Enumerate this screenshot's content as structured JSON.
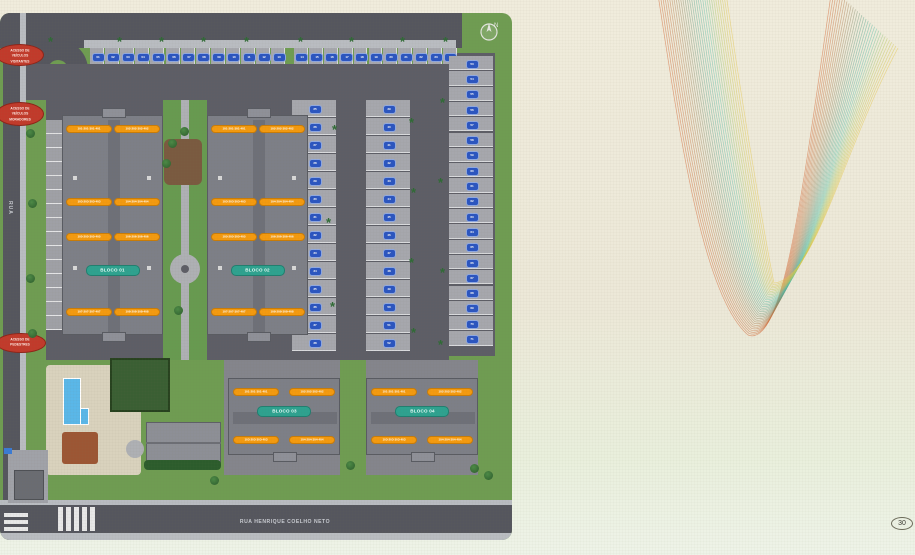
{
  "page": {
    "badge": "30"
  },
  "plan": {
    "streets": {
      "bottom": "RUA HENRIQUE COELHO NETO",
      "left": "RUA"
    },
    "compass": {
      "label": "N"
    },
    "access_labels": [
      {
        "x": -4,
        "y": 31,
        "w": 48,
        "h": 22,
        "lines": [
          "ACESSO DE",
          "VEÍCULOS",
          "VISITANTES"
        ]
      },
      {
        "x": -4,
        "y": 89,
        "w": 48,
        "h": 24,
        "lines": [
          "ACESSO DE",
          "VEÍCULOS",
          "MORADORES"
        ]
      },
      {
        "x": -4,
        "y": 320,
        "w": 50,
        "h": 20,
        "lines": [
          "ACESSO DE",
          "PEDESTRES"
        ]
      }
    ],
    "blocks": [
      {
        "name": "BLOCO 01",
        "orient": "v",
        "x": 62,
        "y": 102,
        "w": 101,
        "h": 220,
        "pill_y": 150,
        "units": [
          {
            "x": 4,
            "y": 10,
            "t": "101·201·301·401"
          },
          {
            "x": 52,
            "y": 10,
            "t": "102·202·302·402"
          },
          {
            "x": 4,
            "y": 83,
            "t": "103·203·303·403"
          },
          {
            "x": 52,
            "y": 83,
            "t": "104·204·304·404"
          },
          {
            "x": 4,
            "y": 118,
            "t": "105·205·305·405"
          },
          {
            "x": 52,
            "y": 118,
            "t": "106·206·306·406"
          },
          {
            "x": 4,
            "y": 193,
            "t": "107·207·307·407"
          },
          {
            "x": 52,
            "y": 193,
            "t": "108·208·308·408"
          }
        ]
      },
      {
        "name": "BLOCO 02",
        "orient": "v",
        "x": 207,
        "y": 102,
        "w": 101,
        "h": 220,
        "pill_y": 150,
        "units": [
          {
            "x": 4,
            "y": 10,
            "t": "101·201·301·401"
          },
          {
            "x": 52,
            "y": 10,
            "t": "102·202·302·402"
          },
          {
            "x": 4,
            "y": 83,
            "t": "103·203·303·403"
          },
          {
            "x": 52,
            "y": 83,
            "t": "104·204·304·404"
          },
          {
            "x": 4,
            "y": 118,
            "t": "105·205·305·405"
          },
          {
            "x": 52,
            "y": 118,
            "t": "106·206·306·406"
          },
          {
            "x": 4,
            "y": 193,
            "t": "107·207·307·407"
          },
          {
            "x": 52,
            "y": 193,
            "t": "108·208·308·408"
          }
        ]
      },
      {
        "name": "BLOCO 03",
        "orient": "h",
        "x": 228,
        "y": 365,
        "w": 112,
        "h": 77,
        "pill_y": 28,
        "units": [
          {
            "x": 5,
            "y": 10,
            "t": "101·201·301·401"
          },
          {
            "x": 61,
            "y": 10,
            "t": "102·202·302·402"
          },
          {
            "x": 5,
            "y": 58,
            "t": "103·203·303·403"
          },
          {
            "x": 61,
            "y": 58,
            "t": "104·204·304·404"
          }
        ]
      },
      {
        "name": "BLOCO 04",
        "orient": "h",
        "x": 366,
        "y": 365,
        "w": 112,
        "h": 77,
        "pill_y": 28,
        "units": [
          {
            "x": 5,
            "y": 10,
            "t": "101·201·301·401"
          },
          {
            "x": 61,
            "y": 10,
            "t": "102·202·302·402"
          },
          {
            "x": 5,
            "y": 58,
            "t": "103·203·303·403"
          },
          {
            "x": 61,
            "y": 58,
            "t": "104·204·304·404"
          }
        ]
      }
    ],
    "parking_groups": [
      {
        "dir": "h",
        "x": 90,
        "y": 35,
        "step": 15.1,
        "numbers": [
          "01",
          "02",
          "03",
          "04",
          "05",
          "06",
          "07",
          "08",
          "09",
          "10",
          "11",
          "12",
          "13"
        ]
      },
      {
        "dir": "h",
        "x": 294,
        "y": 35,
        "step": 14.9,
        "numbers": [
          "14",
          "15",
          "16",
          "17",
          "18",
          "19",
          "20",
          "21",
          "22",
          "23",
          "24"
        ]
      },
      {
        "dir": "v",
        "x": 292,
        "y": 87,
        "step": 18,
        "numbers": [
          "25",
          "26",
          "27",
          "28",
          "29",
          "30",
          "31",
          "32",
          "33",
          "34",
          "35",
          "36",
          "37",
          "38"
        ]
      },
      {
        "dir": "v",
        "x": 366,
        "y": 87,
        "step": 18,
        "numbers": [
          "39",
          "40",
          "41",
          "42",
          "43",
          "44",
          "45",
          "46",
          "47",
          "48",
          "49",
          "50",
          "51",
          "52"
        ]
      },
      {
        "dir": "v",
        "x": 449,
        "y": 43,
        "step": 15.3,
        "numbers": [
          "53",
          "54",
          "55",
          "56",
          "57",
          "58",
          "59",
          "60",
          "61",
          "62",
          "63",
          "64",
          "65",
          "66",
          "67",
          "68",
          "69",
          "70",
          "71"
        ]
      }
    ],
    "palms": [
      [
        52,
        27
      ],
      [
        121,
        27
      ],
      [
        163,
        27
      ],
      [
        205,
        27
      ],
      [
        248,
        27
      ],
      [
        302,
        27
      ],
      [
        353,
        27
      ],
      [
        404,
        27
      ],
      [
        447,
        27
      ],
      [
        336,
        115
      ],
      [
        330,
        208
      ],
      [
        334,
        292
      ],
      [
        413,
        108
      ],
      [
        415,
        178
      ],
      [
        413,
        248
      ],
      [
        415,
        318
      ],
      [
        444,
        88
      ],
      [
        442,
        168
      ],
      [
        444,
        258
      ],
      [
        442,
        330
      ]
    ],
    "trees": [
      [
        172,
        130
      ],
      [
        184,
        118
      ],
      [
        166,
        150
      ],
      [
        178,
        297
      ],
      [
        30,
        120
      ],
      [
        32,
        190
      ],
      [
        30,
        265
      ],
      [
        32,
        320
      ],
      [
        214,
        467
      ],
      [
        350,
        452
      ],
      [
        474,
        455
      ],
      [
        488,
        462
      ]
    ]
  },
  "wave": {
    "colors": [
      "#d4622f",
      "#bf7a4a",
      "#8f8a68",
      "#5ba892",
      "#57c3ac",
      "#b9cc5e",
      "#e6c94a"
    ]
  },
  "colors": {
    "grass": "#6f9c52",
    "road": "#55565e",
    "stall": "#a6a7ad",
    "building": "#7d7f87",
    "unit_label": "#f49a0f",
    "block_pill": "#2ea28f",
    "access": "#c13a2b",
    "parking_badge": "#2b55c0",
    "pool": "#5ab7e8"
  }
}
